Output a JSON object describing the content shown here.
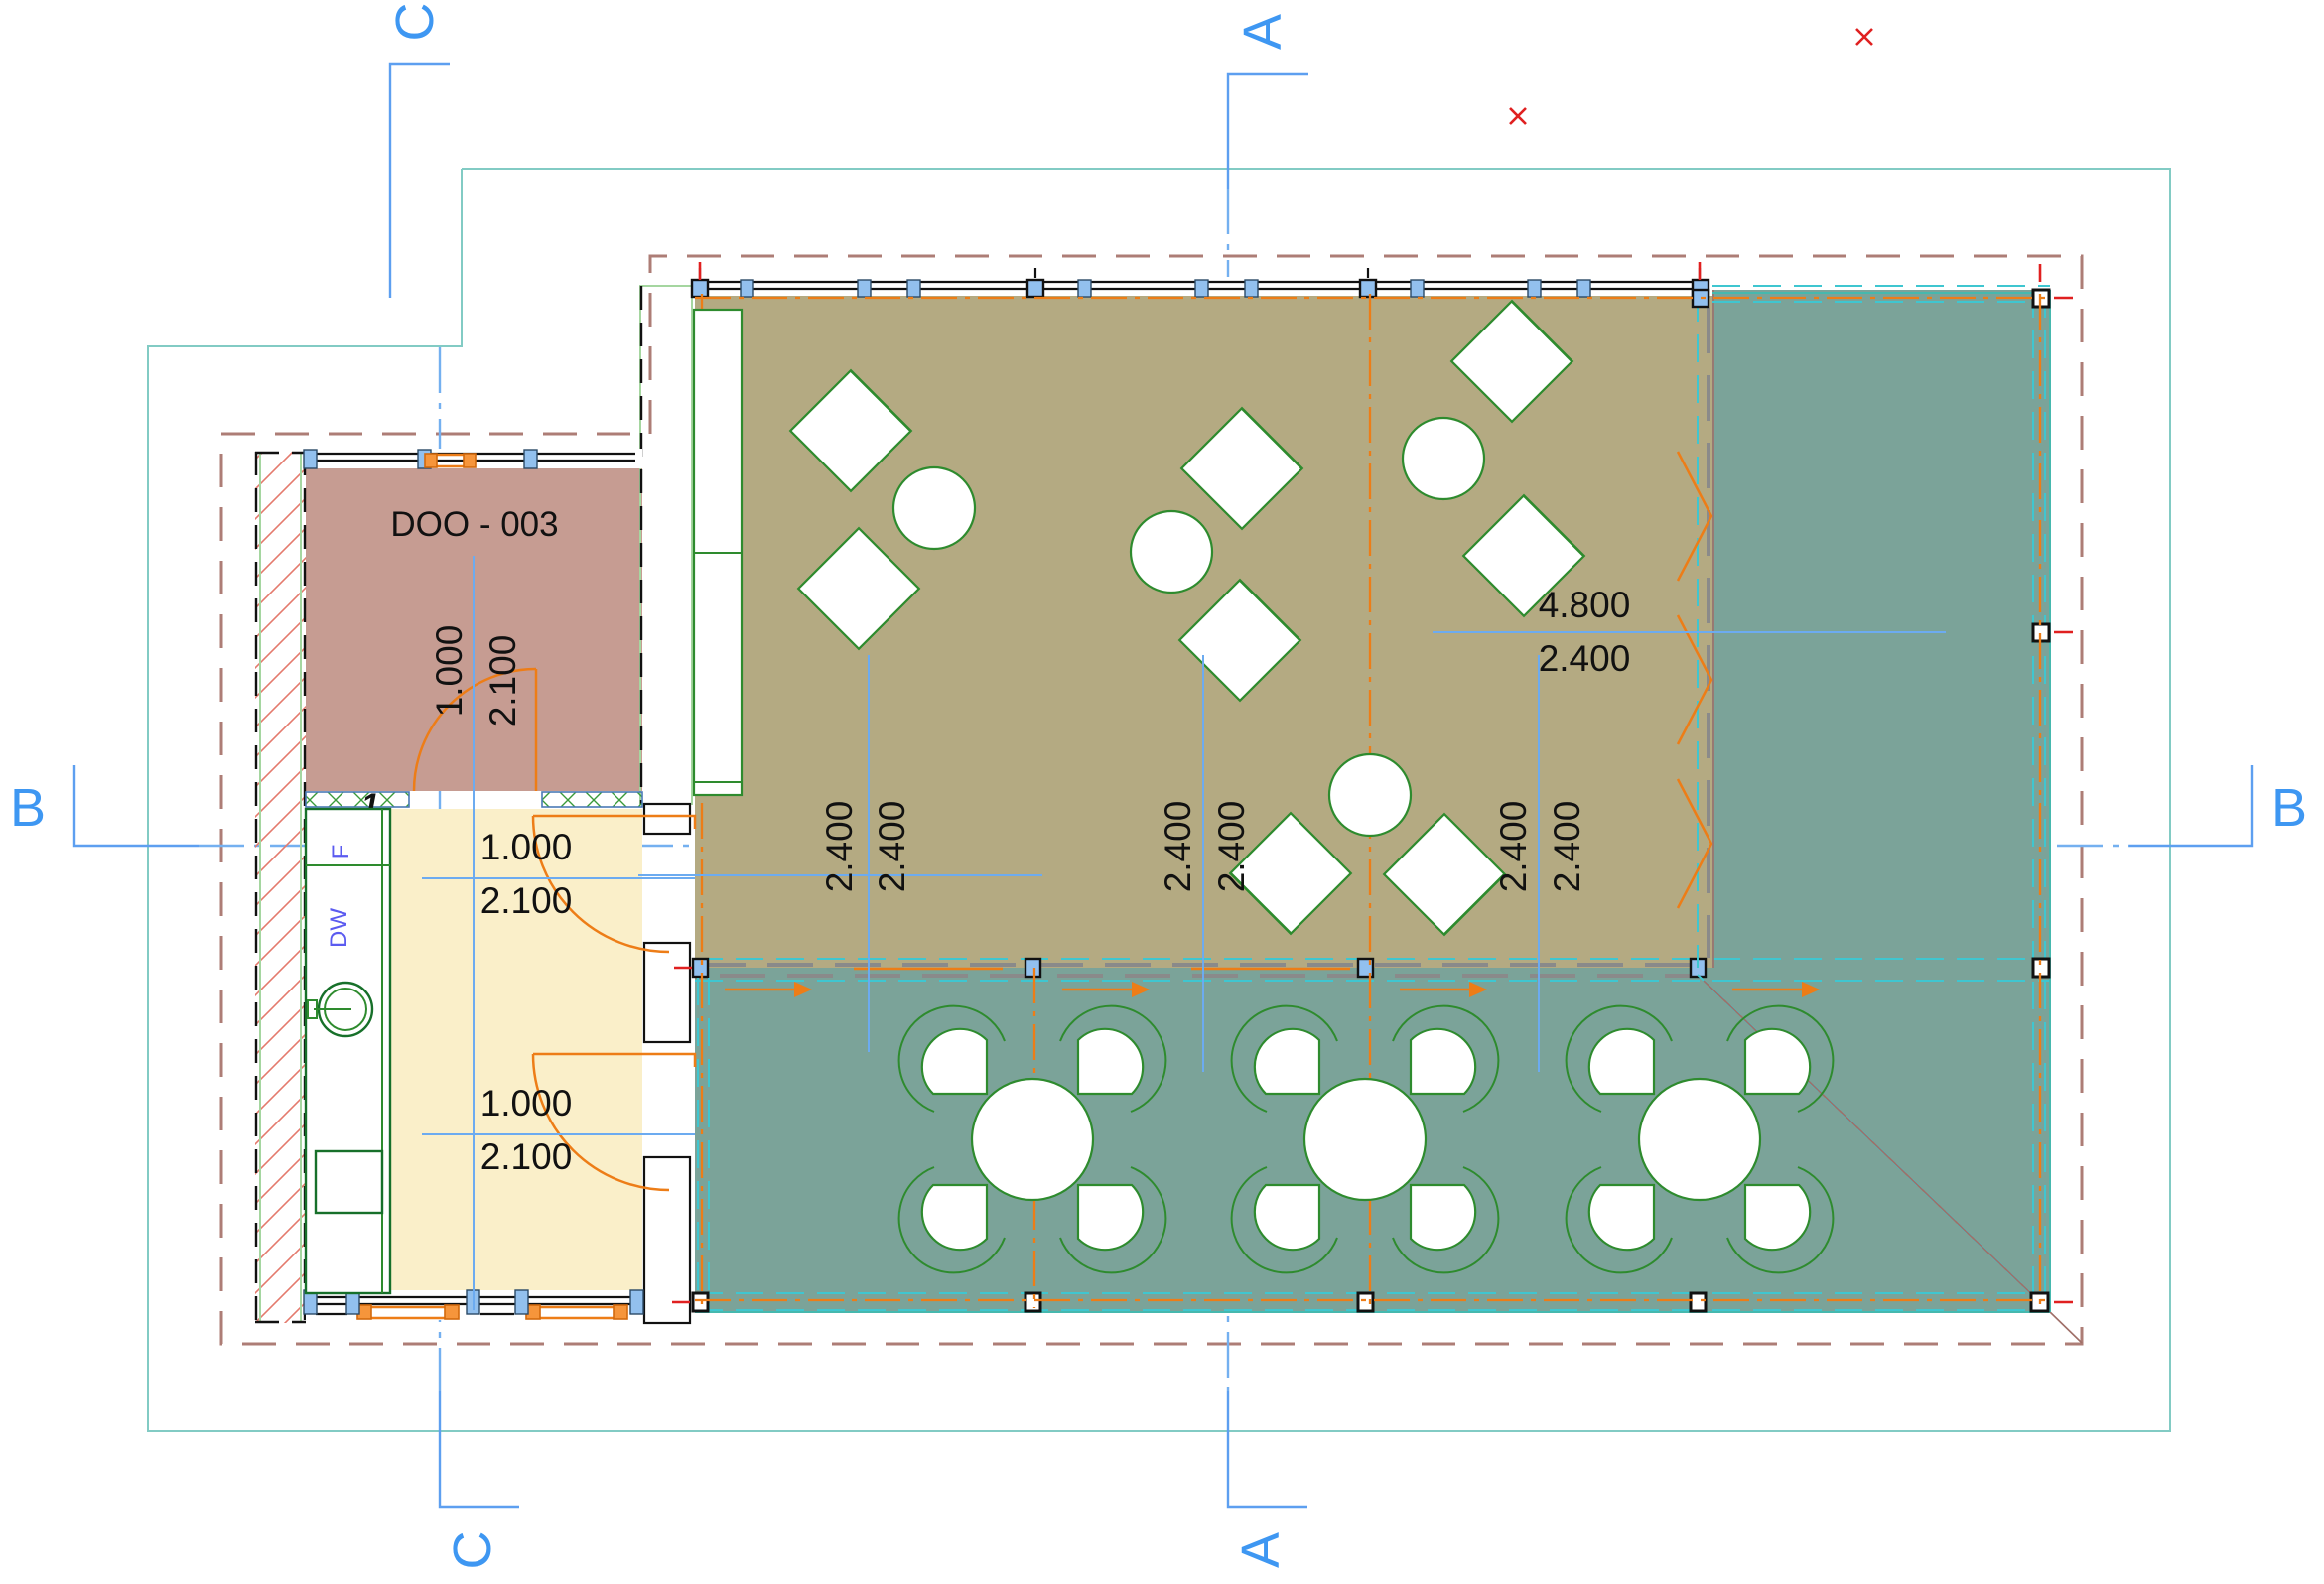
{
  "plan": {
    "room_label": "DOO - 003",
    "door_tag": "1",
    "labels": {
      "dishwasher": "DW",
      "fridge": "F"
    },
    "sections": {
      "a": "A",
      "b": "B",
      "c": "C"
    },
    "dims": {
      "width_4800": "4.800",
      "depth_2400": "2.400",
      "bays": [
        "2.400",
        "2.400",
        "2.400",
        "2.400",
        "2.400",
        "2.400"
      ],
      "doors": [
        {
          "w": "1.000",
          "h": "2.100"
        },
        {
          "w": "1.000",
          "h": "2.100"
        },
        {
          "w": "1.000",
          "h": "2.100"
        }
      ]
    },
    "colors": {
      "dining": "#b4aa82",
      "terrace": "#7ba399",
      "room_pink": "#c69c92",
      "kitchen": "#faefc9",
      "accent_orange": "#ed7d17",
      "accent_cyan": "#3fc6d0",
      "accent_blue": "#3e97f2",
      "boundary_red": "#ad7d76",
      "site_teal": "#82cbc4",
      "furniture_green": "#2e8b2e",
      "marker_red": "#e02020"
    }
  }
}
